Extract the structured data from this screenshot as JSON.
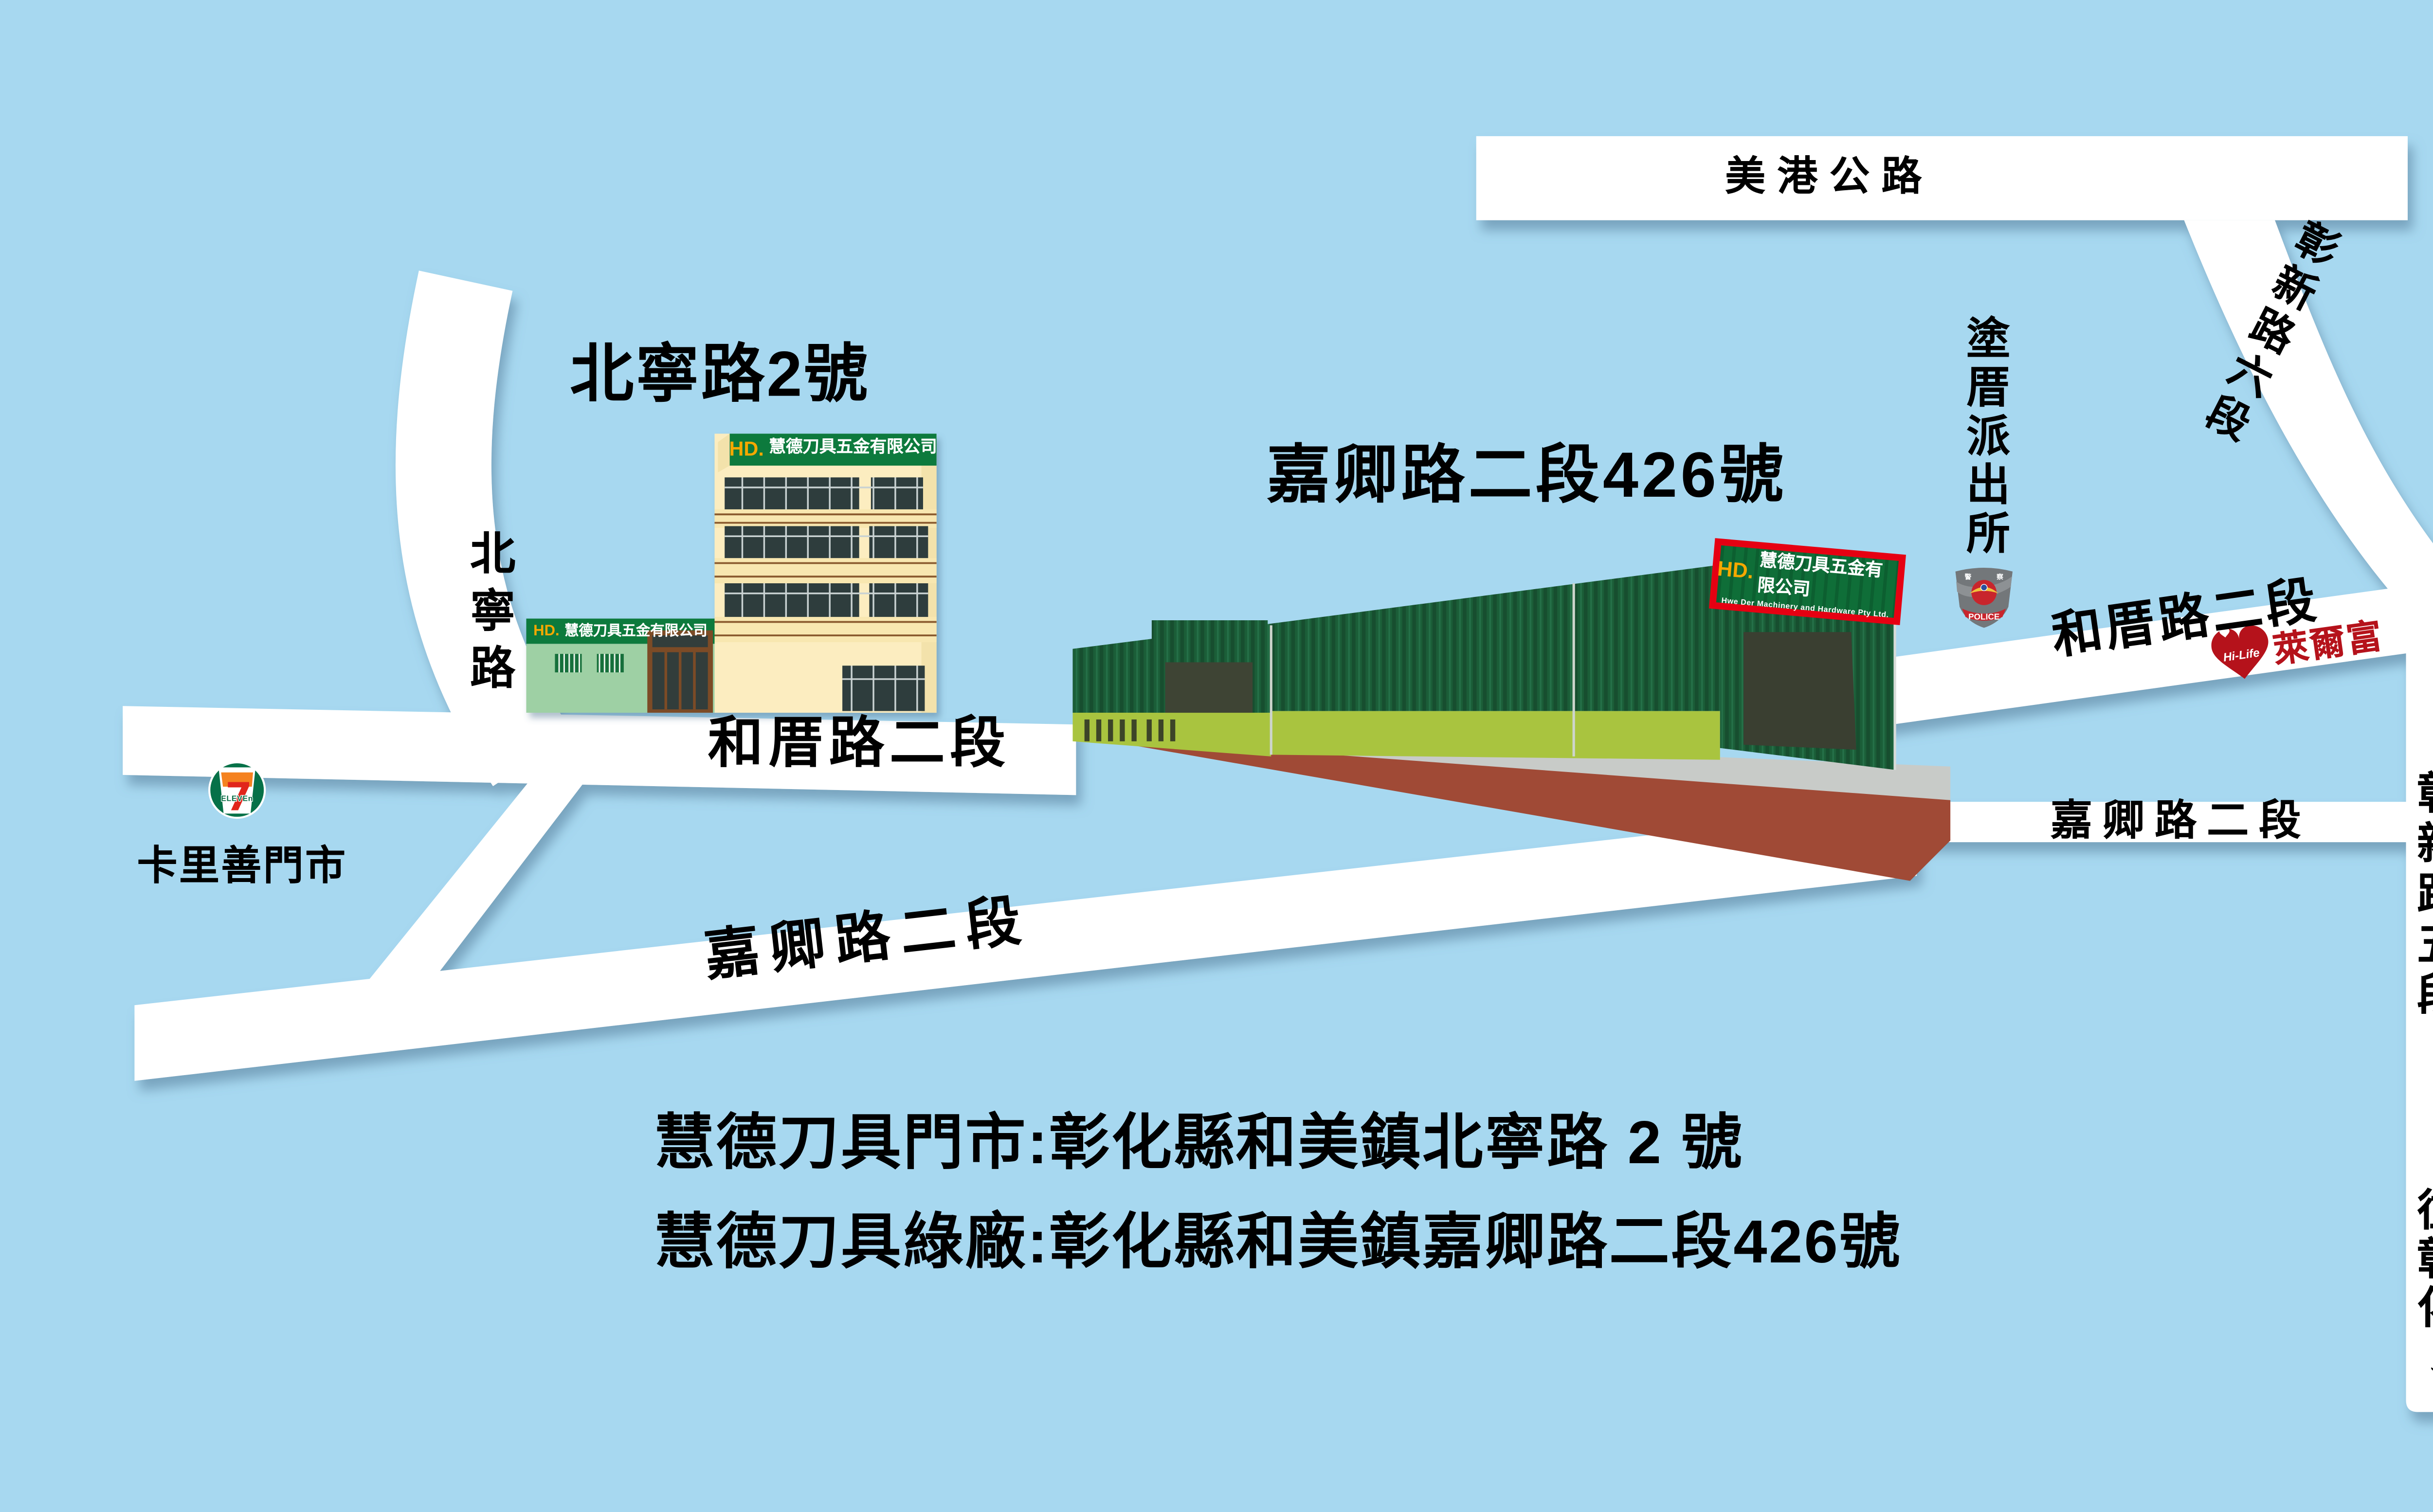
{
  "background_color": "#a7d8f0",
  "roads": {
    "meigang": {
      "label": "美港公路"
    },
    "zhangxin6": {
      "label": "彰新路六段"
    },
    "zhangxin5": {
      "label": "彰新路五段"
    },
    "to_changhua": {
      "label": "往彰化↓"
    },
    "beining": {
      "label": "北寧路"
    },
    "hecuo_left": {
      "label": "和厝路二段"
    },
    "hecuo_right": {
      "label": "和厝路二段"
    },
    "jiaqing_left": {
      "label": "嘉卿路二段"
    },
    "jiaqing_right": {
      "label": "嘉卿路二段"
    }
  },
  "landmarks": {
    "seven_eleven": {
      "name": "卡里善門市",
      "logo_seven": "7",
      "logo_eleven": "ELEVEn"
    },
    "police": {
      "name": "塗厝派出所",
      "badge_text": "POLICE",
      "badge_left": "警",
      "badge_right": "察"
    },
    "hilife": {
      "brand": "Hi-Life",
      "name": "萊爾富"
    },
    "school": {
      "name": "培英國小"
    }
  },
  "store": {
    "address_label": "北寧路2號",
    "sign_hd": "HD.",
    "sign_name": "慧德刀具五金有限公司"
  },
  "factory": {
    "address_label": "嘉卿路二段426號",
    "sign_hd": "HD.",
    "sign_name": "慧德刀具五金有限公司",
    "sign_en": "Hwe Der Machinery and Hardware Pty Ltd."
  },
  "footer": {
    "line1": "慧德刀具門市:彰化縣和美鎮北寧路 2 號",
    "line2": "慧德刀具綠廠:彰化縣和美鎮嘉卿路二段426號"
  },
  "colors": {
    "road": "#ffffff",
    "wall_green": "#1b5e38",
    "sign_green": "#0f6e38",
    "sign_border_red": "#e60012",
    "cream": "#fcedc0",
    "storefront_green": "#9ed0a4",
    "olive": "#a9c43f",
    "ground_gray": "#c8cbc8",
    "ground_red": "#a04a36",
    "hilife_red": "#b5121b",
    "seven_green": "#067148",
    "seven_orange": "#f58220",
    "seven_red": "#e1251b",
    "hd_orange": "#f5a800"
  }
}
